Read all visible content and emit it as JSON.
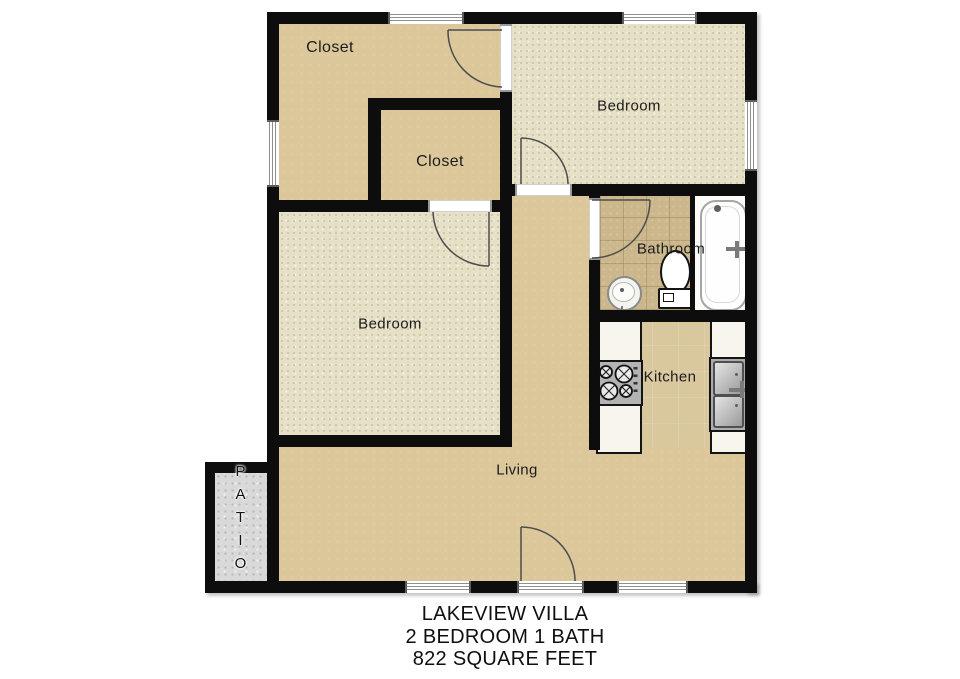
{
  "plan": {
    "caption": [
      "LAKEVIEW VILLA",
      "2 BEDROOM 1 BATH",
      "822 SQUARE FEET"
    ],
    "rooms": {
      "closet_large": "Closet",
      "closet_small": "Closet",
      "bedroom_top": "Bedroom",
      "bedroom_center": "Bedroom",
      "bathroom": "Bathroom",
      "kitchen": "Kitchen",
      "living": "Living",
      "patio": "PATIO"
    },
    "fixtures": [
      "bathtub",
      "toilet",
      "bathroom-sink",
      "stove",
      "kitchen-sink",
      "counters"
    ],
    "colors": {
      "wall": "#0d0d0d",
      "floor_tan": "#dcc79b",
      "carpet": "#e6e0c7",
      "bath_tile": "#cbb78b",
      "kitchen_tile": "#d9c79d",
      "patio_concrete": "#d9d9d9",
      "fixture_white": "#f7f5ee",
      "door_arc": "#4d4d4d"
    }
  }
}
